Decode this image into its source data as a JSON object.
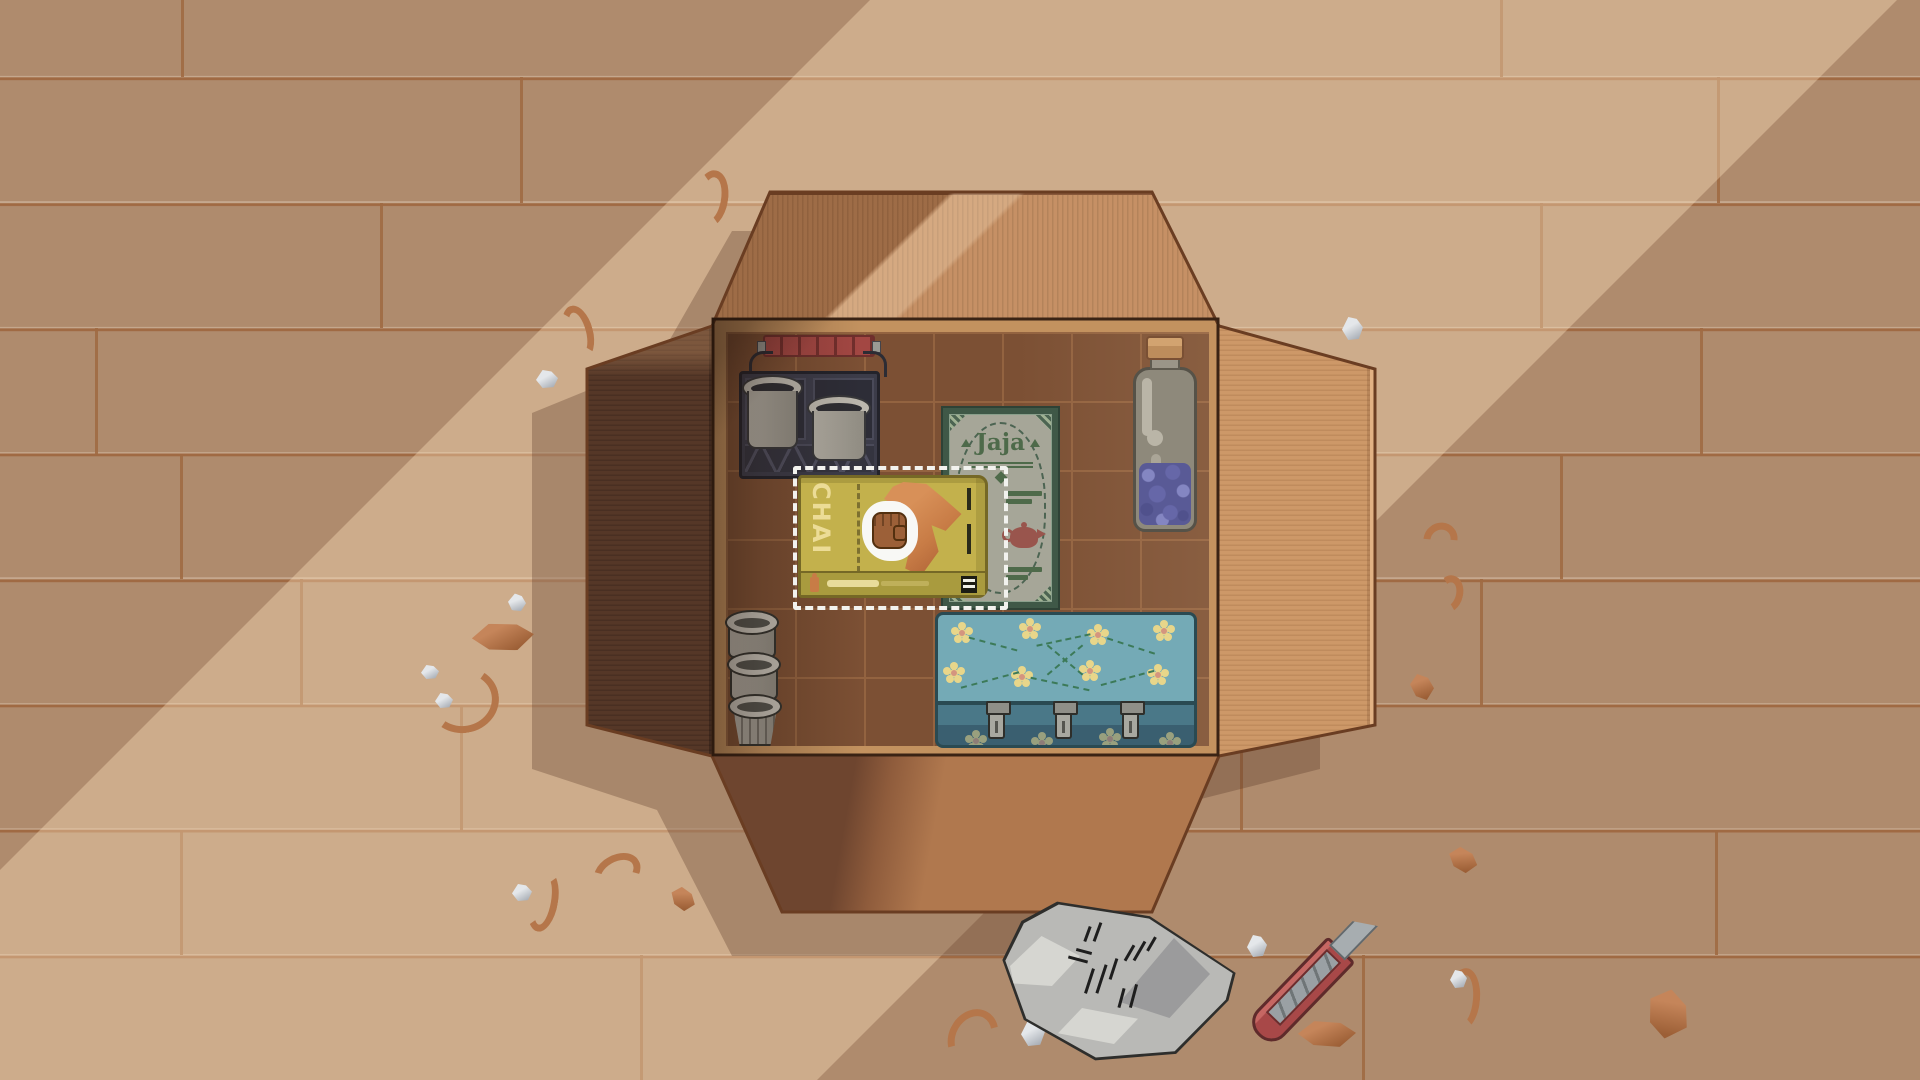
{
  "scene": {
    "description": "Top-down pixel-art unpacking scene: an open cardboard moving box on a wooden plank floor with two diagonal sunbeams",
    "lighting": {
      "sunbeam_band": "diagonal",
      "beam_color": "#ffe2bc"
    }
  },
  "box": {
    "label": "cardboard-moving-box",
    "grid_cols": 7,
    "grid_rows": 6,
    "colors": {
      "flap_lit": "#bf8659",
      "flap_shadow": "#553727",
      "flap_right": "#cd9868",
      "interior": "#7c5034",
      "grid_line": "#936340",
      "trim": "#c3925f"
    }
  },
  "items": {
    "crate": {
      "label": "storage crate with two metal buckets",
      "handle_color": "#a34743",
      "crate_color": "#3c3c49",
      "bucket_color": "#b3afa5"
    },
    "jaja": {
      "title": "Jaja",
      "label": "green tea package with teapot artwork",
      "panel_color": "#a6a698",
      "border_color": "#3f5847",
      "text_color": "#4e6a4a",
      "teapot_color": "#99554d"
    },
    "bottle": {
      "label": "glass jar with lavender sprigs",
      "glass_color": "#8e897b",
      "cork_color": "#bd8d5c",
      "flower_color": "#6667a8"
    },
    "chai": {
      "title": "CHAI",
      "label": "chai tea box (held)",
      "box_color": "#c3b14c",
      "text_color": "#ecdc96",
      "scarf_color": "#c87c46",
      "state": "selected"
    },
    "cups": {
      "label": "stack of three grey cups",
      "count": 3,
      "color": "#b5b1a7"
    },
    "case": {
      "label": "teal suitcase with yellow flower pattern",
      "top_color": "#74aab6",
      "side_color": "#3a5f70",
      "flower_color": "#e8d68a",
      "clasp_count": 3
    }
  },
  "selection": {
    "item": "chai",
    "border_color": "#f2f2ee",
    "cells": "3x2"
  },
  "cursor": {
    "type": "grabbing-hand",
    "skin_color": "#9c6038",
    "halo_color": "#f8f8f5",
    "x": 890,
    "y": 531
  },
  "floor_objects": {
    "paper_wrap": {
      "label": "crumpled packing paper with printed lines",
      "color": "#b9b9b6"
    },
    "box_cutter": {
      "label": "red snap-off box cutter",
      "handle_color": "#a84848",
      "blade_color": "#a7adb0"
    }
  },
  "debris": [
    {
      "type": "curl",
      "x": 694,
      "y": 170,
      "w": 34,
      "h": 58,
      "rot": 10
    },
    {
      "type": "curl",
      "x": 563,
      "y": 305,
      "w": 30,
      "h": 55,
      "rot": -15
    },
    {
      "type": "white",
      "x": 536,
      "y": 370,
      "w": 22,
      "h": 18,
      "rot": 0
    },
    {
      "type": "chip",
      "x": 472,
      "y": 622,
      "w": 62,
      "h": 30,
      "rot": -8
    },
    {
      "type": "curl",
      "x": 430,
      "y": 664,
      "w": 66,
      "h": 72,
      "rot": 80
    },
    {
      "type": "white",
      "x": 508,
      "y": 594,
      "w": 18,
      "h": 17,
      "rot": 10
    },
    {
      "type": "white",
      "x": 421,
      "y": 665,
      "w": 18,
      "h": 14,
      "rot": 0
    },
    {
      "type": "curl",
      "x": 512,
      "y": 886,
      "w": 62,
      "h": 30,
      "rot": 100
    },
    {
      "type": "white",
      "x": 512,
      "y": 884,
      "w": 20,
      "h": 17,
      "rot": 0
    },
    {
      "type": "curl",
      "x": 592,
      "y": 855,
      "w": 50,
      "h": 36,
      "rot": -30
    },
    {
      "type": "chip",
      "x": 670,
      "y": 888,
      "w": 26,
      "h": 22,
      "rot": 20
    },
    {
      "type": "curl",
      "x": 944,
      "y": 1013,
      "w": 58,
      "h": 48,
      "rot": -60
    },
    {
      "type": "white",
      "x": 1021,
      "y": 1020,
      "w": 24,
      "h": 26,
      "rot": 0
    },
    {
      "type": "white",
      "x": 1247,
      "y": 935,
      "w": 20,
      "h": 22,
      "rot": 0
    },
    {
      "type": "chip",
      "x": 1298,
      "y": 1020,
      "w": 58,
      "h": 28,
      "rot": -5
    },
    {
      "type": "chip",
      "x": 1448,
      "y": 848,
      "w": 30,
      "h": 24,
      "rot": 15
    },
    {
      "type": "curl",
      "x": 1448,
      "y": 968,
      "w": 32,
      "h": 62,
      "rot": 5
    },
    {
      "type": "white",
      "x": 1450,
      "y": 970,
      "w": 17,
      "h": 18,
      "rot": 0
    },
    {
      "type": "chip",
      "x": 1645,
      "y": 991,
      "w": 46,
      "h": 46,
      "rot": 30
    },
    {
      "type": "curl",
      "x": 1423,
      "y": 523,
      "w": 35,
      "h": 33,
      "rot": -40
    },
    {
      "type": "curl",
      "x": 1435,
      "y": 575,
      "w": 28,
      "h": 38,
      "rot": 15
    },
    {
      "type": "chip",
      "x": 1410,
      "y": 674,
      "w": 24,
      "h": 26,
      "rot": 0
    },
    {
      "type": "white",
      "x": 1342,
      "y": 317,
      "w": 21,
      "h": 23,
      "rot": 0
    },
    {
      "type": "white",
      "x": 435,
      "y": 693,
      "w": 18,
      "h": 15,
      "rot": 0
    }
  ]
}
